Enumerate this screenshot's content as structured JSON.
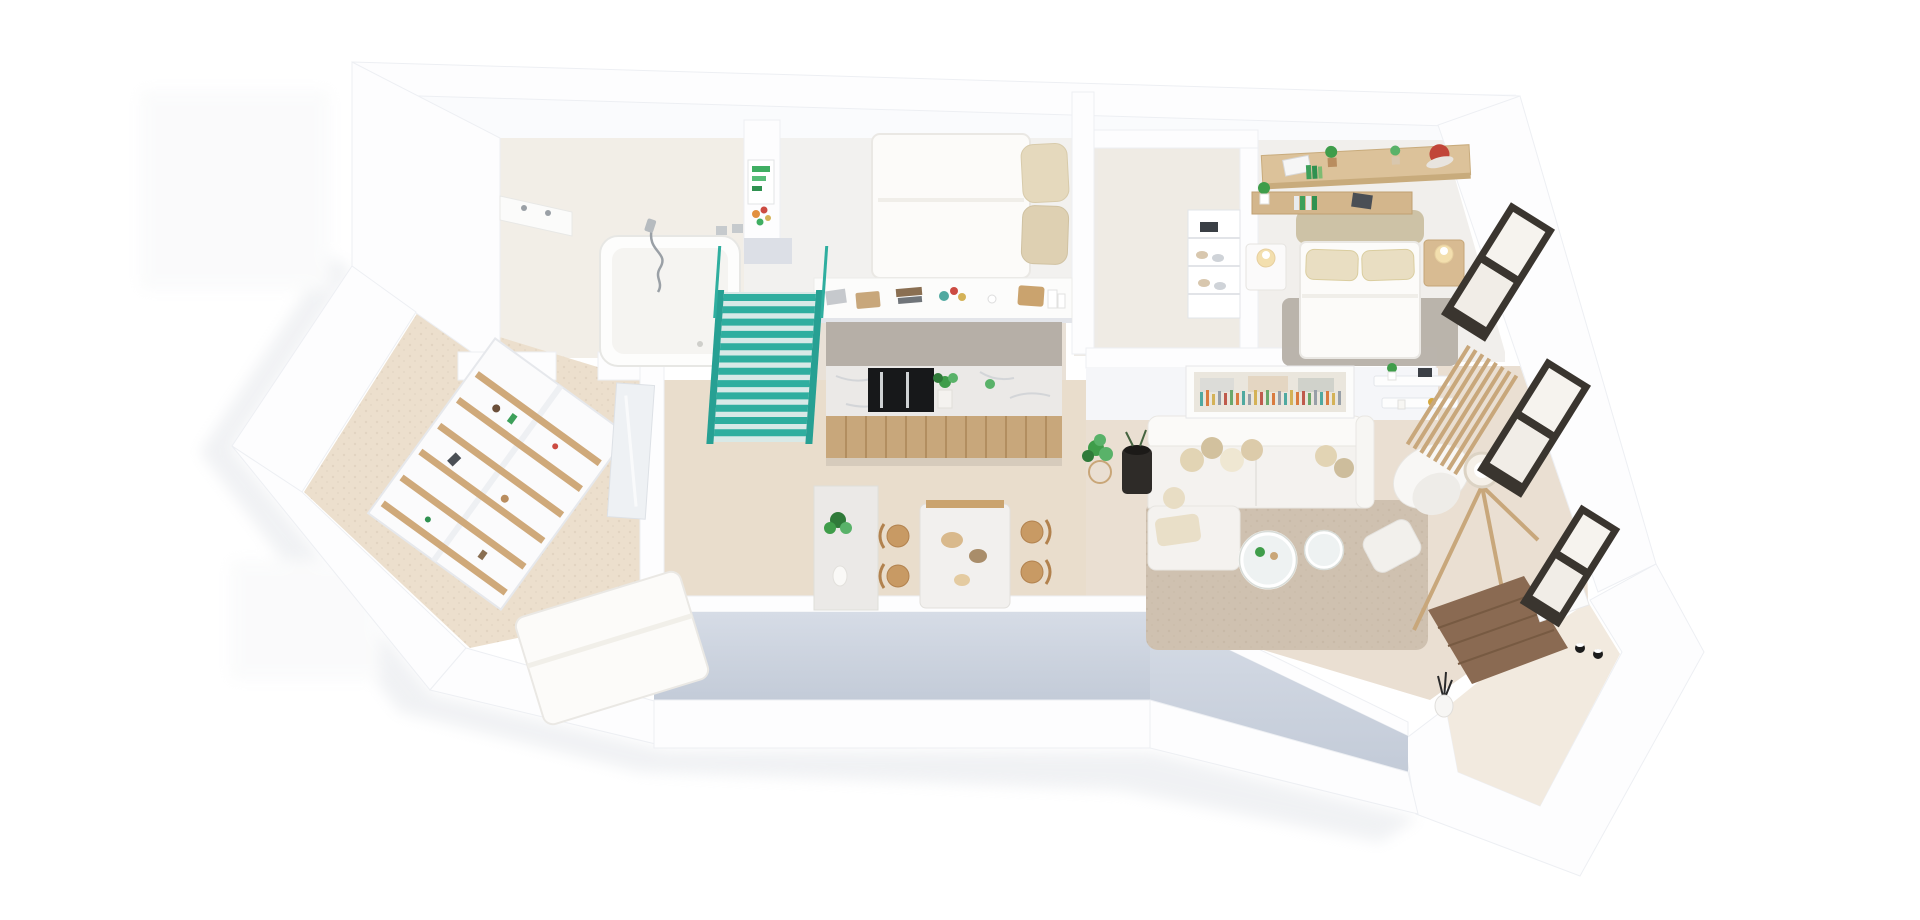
{
  "scene": {
    "type": "3d-isometric-floor-plan-render",
    "description": "Photorealistic top-down 3D render of a furnished apartment floor plan on a white background, white walls, beige floors, teal staircase accent",
    "background": "#ffffff",
    "view": "isometric-top-down"
  },
  "palette": {
    "wall": "#fdfdfe",
    "wallEdge": "#e8eaee",
    "wallFaceTop": "#d6dce6",
    "wallFaceBottom": "#c3cbd8",
    "northFace": "#fafbfd",
    "floorWarm": "#e9ddcc",
    "floorLight": "#f2eee7",
    "floorPale": "#f2f1ef",
    "floorStorage": "#ecdfcd",
    "floorLiving": "#eadfd2",
    "floorTerrace": "#f2eadf",
    "teal": "#2fae9f",
    "tealDark": "#27a093",
    "tealLight": "#d8e9e7",
    "wood": "#c8a77b",
    "woodLight": "#d8bb92",
    "woodDark": "#8a6a52",
    "woodPlank": "#b28e60",
    "marble": "#ebe9e7",
    "marbleVein": "#c3c8ce",
    "nicheGray": "#b6afa7",
    "frameDark": "#3a352f",
    "applianceBlack": "#17181a",
    "plant": "#3f9d4a",
    "plantDark": "#2f7a39",
    "plantLight": "#59b269",
    "rug": "#cfc1b0",
    "rugGray": "#b6b0a8",
    "beige": "#e5d9bd",
    "beigeDark": "#cdc2a6",
    "glow": "#f3dfae",
    "artTeal": "#4fa9a0",
    "artOrange": "#d97b3f",
    "artYellow": "#d4b257",
    "artGray": "#98a0a8",
    "artRed": "#bf5b4d",
    "capRed": "#c14538",
    "decorBlack": "#1c1c1c"
  },
  "rooms": [
    {
      "id": "bathroom",
      "label": "Bathroom",
      "furniture": [
        "bathtub",
        "handheld-shower",
        "vanity-counter",
        "wall-column-with-green-art"
      ]
    },
    {
      "id": "bedroom-1",
      "label": "Bedroom 1",
      "furniture": [
        "double-bed",
        "beige-pillows",
        "half-wall-counter-with-decor"
      ]
    },
    {
      "id": "staircase",
      "label": "Staircase",
      "furniture": [
        "teal-stairs",
        "teal-railing"
      ]
    },
    {
      "id": "kitchen",
      "label": "Kitchen",
      "furniture": [
        "counter-top",
        "marble-backsplash",
        "built-in-black-appliance",
        "wood-cabinet-front",
        "potted-plant"
      ]
    },
    {
      "id": "hall-closet",
      "label": "Hall / Walk-in closet",
      "furniture": [
        "wardrobe-niche",
        "shoe-shelf"
      ]
    },
    {
      "id": "bedroom-2",
      "label": "Bedroom 2",
      "furniture": [
        "double-bed",
        "upholstered-headboard",
        "two-nightstands",
        "bedside-lamps",
        "wall-desk-shelf",
        "plants",
        "red-cap",
        "gray-rug",
        "window"
      ]
    },
    {
      "id": "living-room",
      "label": "Living room",
      "furniture": [
        "sectional-sofa",
        "throw-pillows",
        "two-round-coffee-tables",
        "armchair",
        "ottoman",
        "tripod-floor-lamp",
        "abstract-wall-art",
        "wall-shelves",
        "wood-slat-partition",
        "area-rug",
        "plant-on-stand",
        "black-planter"
      ]
    },
    {
      "id": "dining-area",
      "label": "Dining area",
      "furniture": [
        "marble-dining-table",
        "four-wood-chairs",
        "marble-console",
        "plant",
        "decor-bowls"
      ]
    },
    {
      "id": "storage-room",
      "label": "Storage / Bedroom 3",
      "furniture": [
        "shelving-unit-with-wood-shelves",
        "mattress-bed",
        "mirror-panel"
      ]
    },
    {
      "id": "entry",
      "label": "Entry",
      "furniture": [
        "dark-wood-floor",
        "white-console",
        "vase-with-branches",
        "black-decor-objects"
      ]
    },
    {
      "id": "terrace",
      "label": "Terrace",
      "furniture": [
        "l-shaped-white-deck"
      ]
    }
  ],
  "windows": {
    "count": 3,
    "frame_color": "#3a352f",
    "location": "right-facade"
  }
}
